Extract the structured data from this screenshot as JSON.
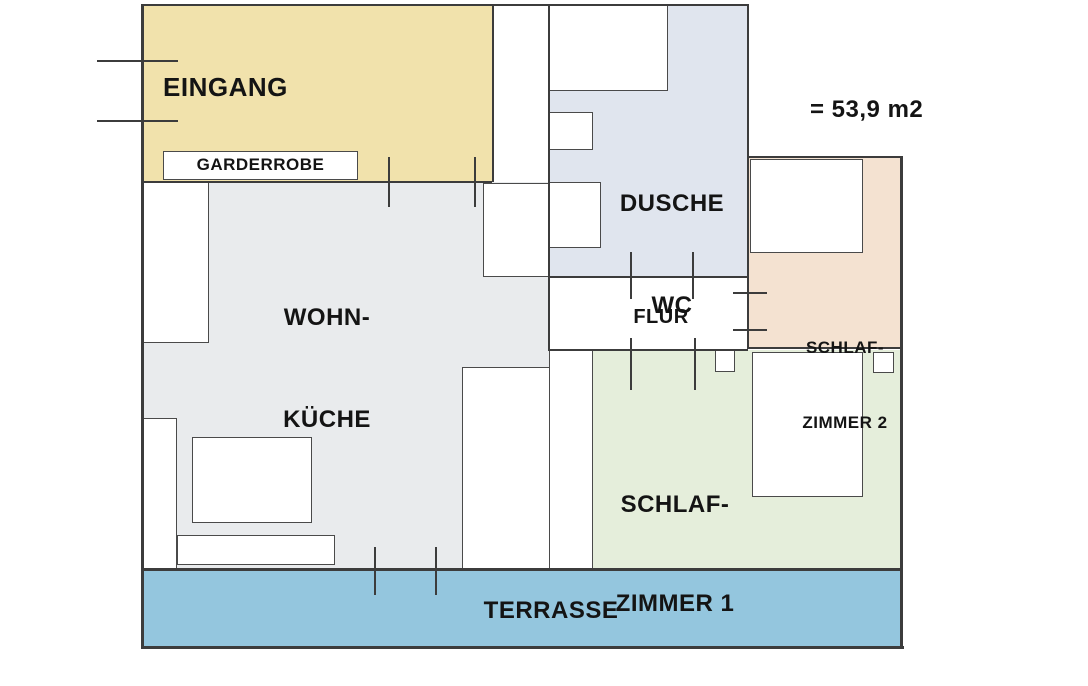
{
  "annotation": {
    "area_text": "= 53,9 m2"
  },
  "rooms": {
    "eingang": {
      "label": "EINGANG",
      "fill": "#f1e2ac"
    },
    "garderrobe": {
      "label": "GARDERROBE",
      "fill": "#ffffff"
    },
    "wohn_kueche": {
      "label_line1": "WOHN-",
      "label_line2": "KÜCHE",
      "fill": "#e9ebed"
    },
    "dusche_wc": {
      "label_line1": "DUSCHE",
      "label_line2": "WC",
      "fill": "#e0e5ee"
    },
    "flur": {
      "label": "FLUR",
      "fill": "#ffffff"
    },
    "schlafzimmer_2": {
      "label_line1": "SCHLAF-",
      "label_line2": "ZIMMER 2",
      "fill": "#f4e2d1"
    },
    "schlafzimmer_1": {
      "label_line1": "SCHLAF-",
      "label_line2": "ZIMMER 1",
      "fill": "#e5eedb"
    },
    "terrasse": {
      "label": "TERRASSE",
      "fill": "#94c6de"
    }
  },
  "colors": {
    "wall_line": "#3c3c3c",
    "fixture_border": "#4a4a4a",
    "text": "#141414"
  }
}
